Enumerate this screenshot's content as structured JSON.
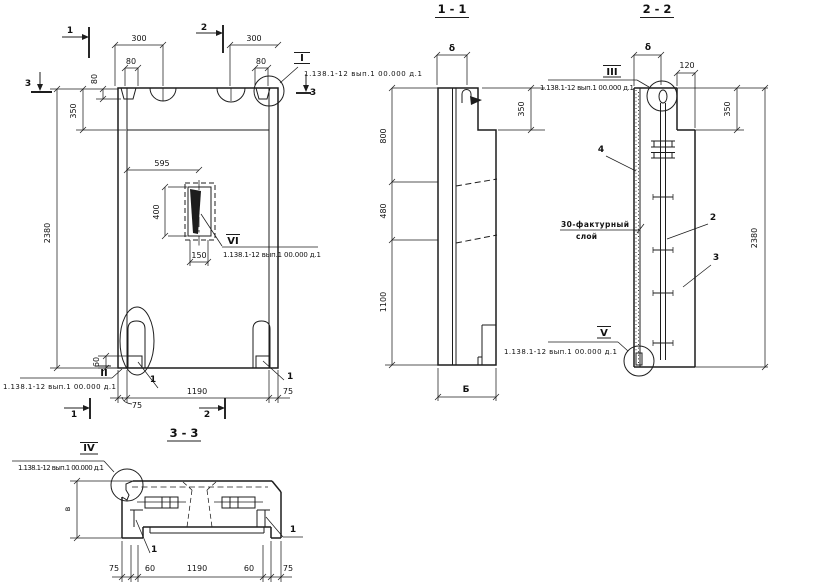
{
  "series_note": "1.138.1-12 вып.1 00.000 д.1",
  "views": {
    "main": {
      "cut1": "1",
      "cut2": "2",
      "cut3": "3",
      "det_i": "I",
      "det_ii": "II",
      "det_vi": "VI",
      "item1": "1",
      "dims": {
        "t300l": "300",
        "t300r": "300",
        "t80l": "80",
        "t80r": "80",
        "s80": "80",
        "s350": "350",
        "s2380": "2380",
        "o595": "595",
        "o400": "400",
        "o150": "150",
        "c60": "60",
        "b75l": "75",
        "b1190": "1190",
        "b75r": "75"
      }
    },
    "s11": {
      "title": "1 - 1",
      "dims": {
        "delta": "δ",
        "d800": "800",
        "d480": "480",
        "d1100": "1100",
        "d350": "350",
        "width_b": "Б"
      }
    },
    "s22": {
      "title": "2 - 2",
      "det_iii": "III",
      "det_v": "V",
      "item2": "2",
      "item3": "3",
      "item4": "4",
      "note1": "30-фактурный",
      "note2": "слой",
      "dims": {
        "delta": "δ",
        "d120": "120",
        "d350": "350",
        "d2380": "2380"
      }
    },
    "s33": {
      "title": "3 - 3",
      "det_iv": "IV",
      "item1": "1",
      "dims": {
        "height_v": "в",
        "b75l": "75",
        "b60l": "60",
        "b1190": "1190",
        "b60r": "60",
        "b75r": "75"
      }
    }
  }
}
